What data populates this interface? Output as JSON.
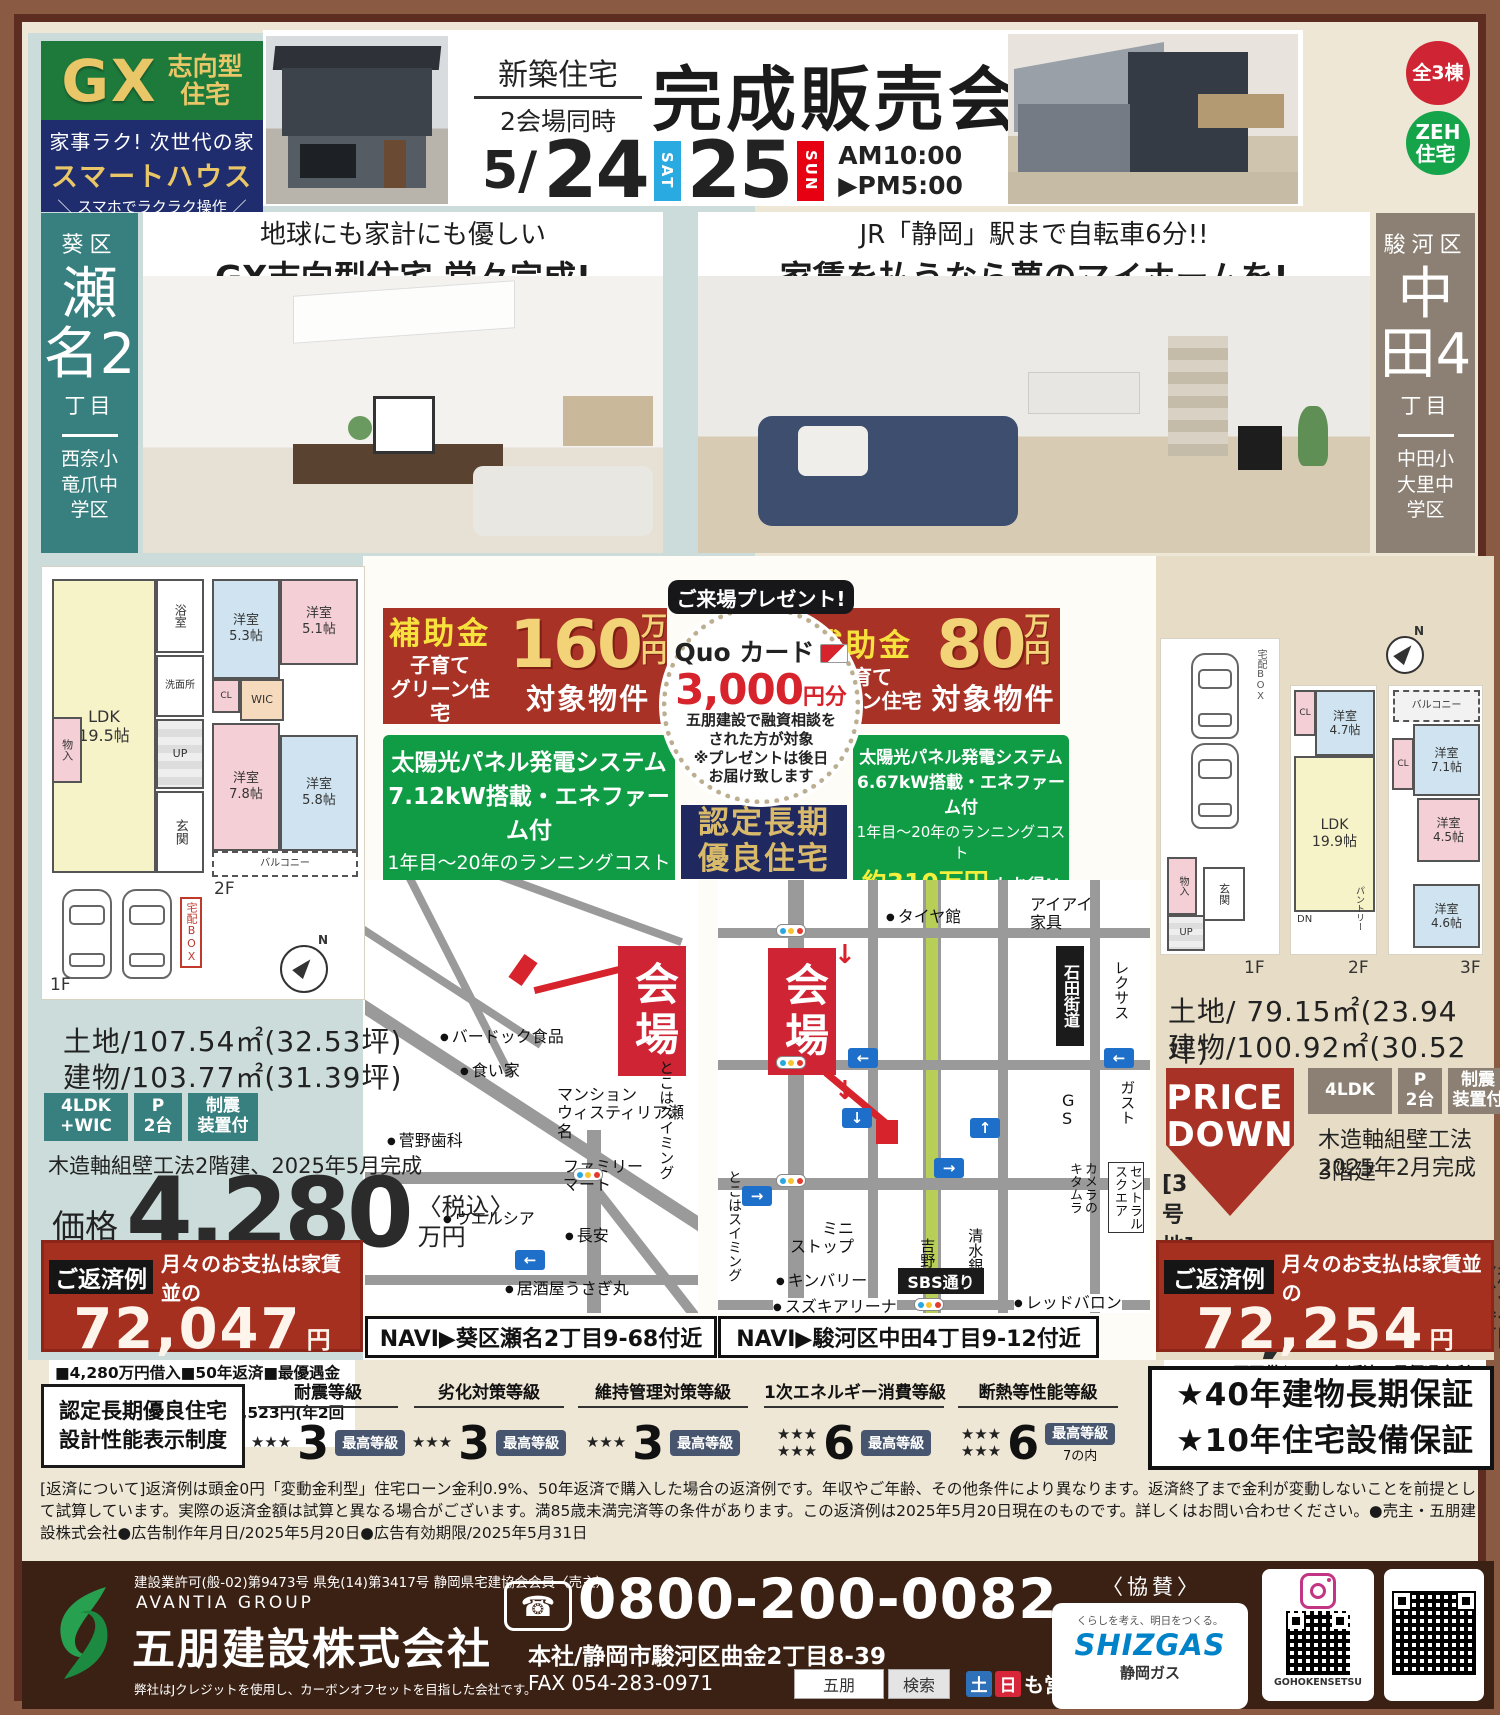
{
  "header": {
    "gx": {
      "big": "GX",
      "type1": "志向型",
      "type2": "住宅"
    },
    "smart": {
      "l1": "家事ラク! 次世代の家",
      "l2": "スマートハウス",
      "l3": "＼ スマホでラクラク操作 ／"
    },
    "event": {
      "tag1": "新築住宅",
      "tag2": "2会場同時",
      "title": "完成販売会",
      "month": "5/",
      "day1": "24",
      "day1_w": "SAT",
      "day2": "25",
      "day2_w": "SUN",
      "time1": "AM10:00",
      "time2": "▶PM5:00"
    },
    "badge_units": "全3棟",
    "badge_zeh": "ZEH\n住宅"
  },
  "left": {
    "district": "葵区",
    "town_num": "瀬名2",
    "chome": "丁目",
    "school": "西奈小\n竜爪中\n学区",
    "headline1": "地球にも家計にも優しい",
    "headline2": "GX志向型住宅 堂々完成!",
    "subsidy": {
      "label": "補助金",
      "sub": "子育て\nグリーン住宅",
      "amount": "160",
      "unit": "万\n円",
      "target": "対象物件"
    },
    "solar": {
      "l1": "太陽光パネル発電システム",
      "l2": "7.12kW搭載・エネファーム付",
      "l3": "1年目〜20年のランニングコスト",
      "amount": "約314万円",
      "l4": "もお得!!",
      "note": "※詳しくはお問い合わせください"
    },
    "plan": {
      "f1_label": "1F",
      "f2_label": "2F",
      "rooms_f1": [
        "LDK\n19.5帖",
        "物入",
        "浴室",
        "洗面所",
        "玄関",
        "UP",
        "宅配BOX"
      ],
      "rooms_f2": [
        "洋室\n5.3帖",
        "洋室\n5.1帖",
        "WIC",
        "CL",
        "洋室\n7.8帖",
        "洋室\n5.8帖",
        "バルコニー"
      ]
    },
    "land": "土地/107.54㎡(32.53坪)",
    "building": "建物/103.77㎡(31.39坪)",
    "spec_badges": [
      "4LDK\n+WIC",
      "P\n2台",
      "制震\n装置付"
    ],
    "construction": "木造軸組壁工法2階建、2025年5月完成",
    "price_label": "価格",
    "price": "4,280",
    "tax": "〈税込〉",
    "price_unit": "万円",
    "repay": {
      "label": "ご返済例",
      "heading": "月々のお支払は家賃並の",
      "amount": "72,047",
      "unit": "円",
      "note1": "■4,280万円借入■50年返済■最優遇金利0.9%",
      "note2": "■ボーナス加算1回当り99,523円(年2回あり)"
    },
    "map": {
      "venue": "会場",
      "navi": "NAVI▶葵区瀬名2丁目9-68付近",
      "labels": [
        "バードック食品",
        "食い家",
        "マンション\nウィスティリア瀬名",
        "菅野歯科",
        "ファミリー\nマート",
        "ウエルシア",
        "長安",
        "とこはスイミング",
        "居酒屋うさぎ丸"
      ]
    }
  },
  "right": {
    "district": "駿河区",
    "town_num": "中田4",
    "chome": "丁目",
    "school": "中田小\n大里中\n学区",
    "headline1": "JR「静岡」駅まで自転車6分!!",
    "headline2": "家賃を払うなら夢のマイホームを!",
    "subsidy": {
      "label": "補助金",
      "sub": "子育て\nグリーン住宅",
      "amount": "80",
      "unit": "万\n円",
      "target": "対象物件"
    },
    "solar": {
      "l1": "太陽光パネル発電システム",
      "l2": "6.67kW搭載・エネファーム付",
      "l3": "1年目〜20年のランニングコスト",
      "amount": "約310万円",
      "l4": "もお得!!",
      "note": "※詳しくはお問い合わせください"
    },
    "plan": {
      "f1_label": "1F",
      "f2_label": "2F",
      "f3_label": "3F",
      "rooms_f1": [
        "宅配BOX",
        "物入",
        "玄関",
        "UP"
      ],
      "rooms_f2": [
        "洋室\n4.7帖",
        "CL",
        "LDK\n19.9帖",
        "DN",
        "パントリー"
      ],
      "rooms_f3": [
        "バルコニー",
        "洋室\n7.1帖",
        "CL",
        "洋室\n4.5帖",
        "洋室\n4.6帖"
      ]
    },
    "land": "土地/ 79.15㎡(23.94坪)",
    "building": "建物/100.92㎡(30.52坪)",
    "price_down": "PRICE\nDOWN",
    "spec_badges": [
      "4LDK",
      "P\n2台",
      "制震\n装置付"
    ],
    "construction1": "木造軸組壁工法3階建",
    "construction2": "2025年2月完成",
    "lot": "[3号地]",
    "price_label": "価格",
    "price": "4,290",
    "tax": "〈税込〉",
    "price_unit": "万円",
    "repay": {
      "label": "ご返済例",
      "heading": "月々のお支払は家賃並の",
      "amount": "72,254",
      "unit": "円",
      "note1": "■4,290万円借入■50年返済■最優遇金利0.9%",
      "note2": "■ボーナス加算1回当り99,523円(年2回あり)"
    },
    "map": {
      "venue": "会場",
      "navi": "NAVI▶駿河区中田4丁目9-12付近",
      "labels": [
        "タイヤ館",
        "アイアイ\n家具",
        "石田街道",
        "レクサス",
        "ガスト",
        "G\nS",
        "ミニ\nストップ",
        "キンバリー",
        "吉野家",
        "清水銀行",
        "カメラの\nキタムラ",
        "セントラル\nスクエア",
        "SBS通り",
        "スズキアリーナ",
        "レッドバロン",
        "とこはスイミング"
      ]
    }
  },
  "gift": {
    "ribbon": "ご来場プレゼント!",
    "card": "Quo カード",
    "amount": "3,000",
    "unit": "円分",
    "cond": "五朋建設で融資相談を\nされた方が対象",
    "note": "※プレゼントは後日\nお届け致します"
  },
  "certified": {
    "l1": "認定長期",
    "l2": "優良住宅"
  },
  "ratings": {
    "title": "認定長期優良住宅\n設計性能表示制度",
    "items": [
      {
        "name": "耐震等級",
        "stars": "★★★",
        "value": "3",
        "badge": "最高等級"
      },
      {
        "name": "劣化対策等級",
        "stars": "★★★",
        "value": "3",
        "badge": "最高等級"
      },
      {
        "name": "維持管理対策等級",
        "stars": "★★★",
        "value": "3",
        "badge": "最高等級"
      },
      {
        "name": "1次エネルギー消費等級",
        "stars": "★★★\n★★★",
        "value": "6",
        "badge": "最高等級"
      },
      {
        "name": "断熱等性能等級",
        "stars": "★★★\n★★★",
        "value": "6",
        "badge": "最高等級",
        "badge2": "7の内"
      }
    ],
    "g1": "★40年建物長期保証",
    "g2": "★10年住宅設備保証"
  },
  "fine_print": "[返済について]返済例は頭金0円「変動金利型」住宅ローン金利0.9%、50年返済で購入した場合の返済例です。年収やご年齢、その他条件により異なります。返済終了まで金利が変動しないことを前提として試算しています。実際の返済金額は試算と異なる場合がございます。満85歳未満完済等の条件があります。この返済例は2025年5月20日現在のものです。詳しくはお問い合わせください。●売主・五朋建設株式会社●広告制作年月日/2025年5月20日●広告有効期限/2025年5月31日",
  "footer": {
    "license": "建設業許可(般-02)第9473号 県免(14)第3417号 静岡県宅建協会会員〈売主〉",
    "group": "AVANTIA GROUP",
    "company": "五朋建設株式会社",
    "eco": "弊社はJクレジットを使用し、カーボンオフセットを目指した会社です。",
    "phone": "0800-200-0082",
    "address": "本社/静岡市駿河区曲金2丁目8-39",
    "fax": "FAX 054-283-0971",
    "search_word": "五朋",
    "search_btn": "検索",
    "sat": "土",
    "sun": "日",
    "hours": "も営業",
    "sponsor": "〈協賛〉",
    "shizgas_slogan": "くらしを考え、明日をつくる。",
    "shizgas_brand": "SHIZGAS",
    "shizgas_name": "静岡ガス",
    "insta": "GOHOKENSETSU"
  },
  "colors": {
    "teal": "#37807f",
    "taupe": "#8b8073",
    "red": "#a93226",
    "green": "#0f9c45",
    "navy": "#1f2960",
    "gold": "#e9c667"
  }
}
